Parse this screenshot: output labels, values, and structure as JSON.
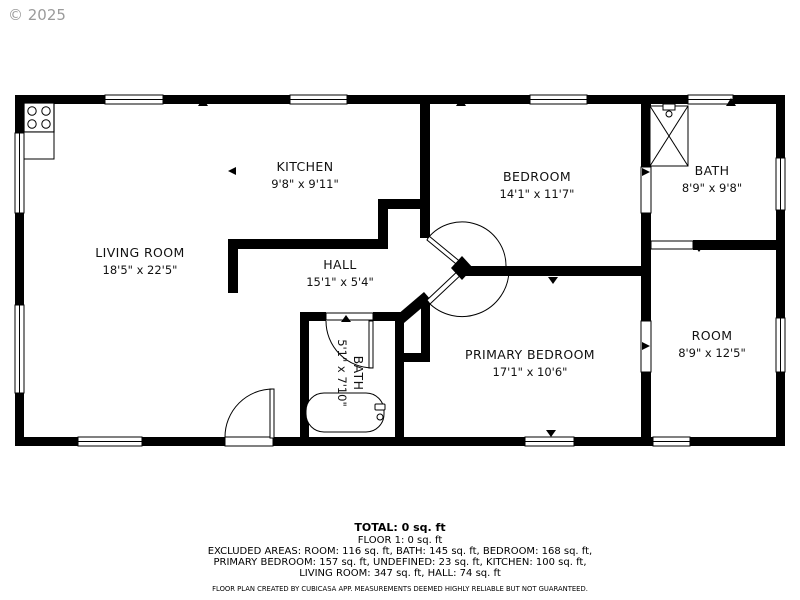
{
  "watermark": "© 2025",
  "colors": {
    "wall": "#000000",
    "text": "#111111",
    "watermark": "#9b9b9b",
    "background": "#ffffff"
  },
  "rooms": [
    {
      "id": "living-room",
      "name": "LIVING ROOM",
      "dims": "18'5\" x 22'5\""
    },
    {
      "id": "kitchen",
      "name": "KITCHEN",
      "dims": "9'8\" x 9'11\""
    },
    {
      "id": "hall",
      "name": "HALL",
      "dims": "15'1\" x 5'4\""
    },
    {
      "id": "bedroom",
      "name": "BEDROOM",
      "dims": "14'1\" x 11'7\""
    },
    {
      "id": "bath",
      "name": "BATH",
      "dims": "8'9\" x 9'8\""
    },
    {
      "id": "room",
      "name": "ROOM",
      "dims": "8'9\" x 12'5\""
    },
    {
      "id": "primary-bedroom",
      "name": "PRIMARY BEDROOM",
      "dims": "17'1\" x 10'6\""
    },
    {
      "id": "bath-small",
      "name": "BATH",
      "dims": "5'1\" x 7'10\""
    }
  ],
  "footer": {
    "total": "TOTAL: 0 sq. ft",
    "floor": "FLOOR 1: 0 sq. ft",
    "excluded_line1": "EXCLUDED AREAS: ROOM: 116 sq. ft, BATH: 145 sq. ft, BEDROOM: 168 sq. ft,",
    "excluded_line2": "PRIMARY BEDROOM: 157 sq. ft, UNDEFINED: 23 sq. ft, KITCHEN: 100 sq. ft,",
    "excluded_line3": "LIVING ROOM: 347 sq. ft, HALL: 74 sq. ft",
    "disclaimer": "FLOOR PLAN CREATED BY CUBICASA APP. MEASUREMENTS DEEMED HIGHLY RELIABLE BUT NOT GUARANTEED."
  }
}
